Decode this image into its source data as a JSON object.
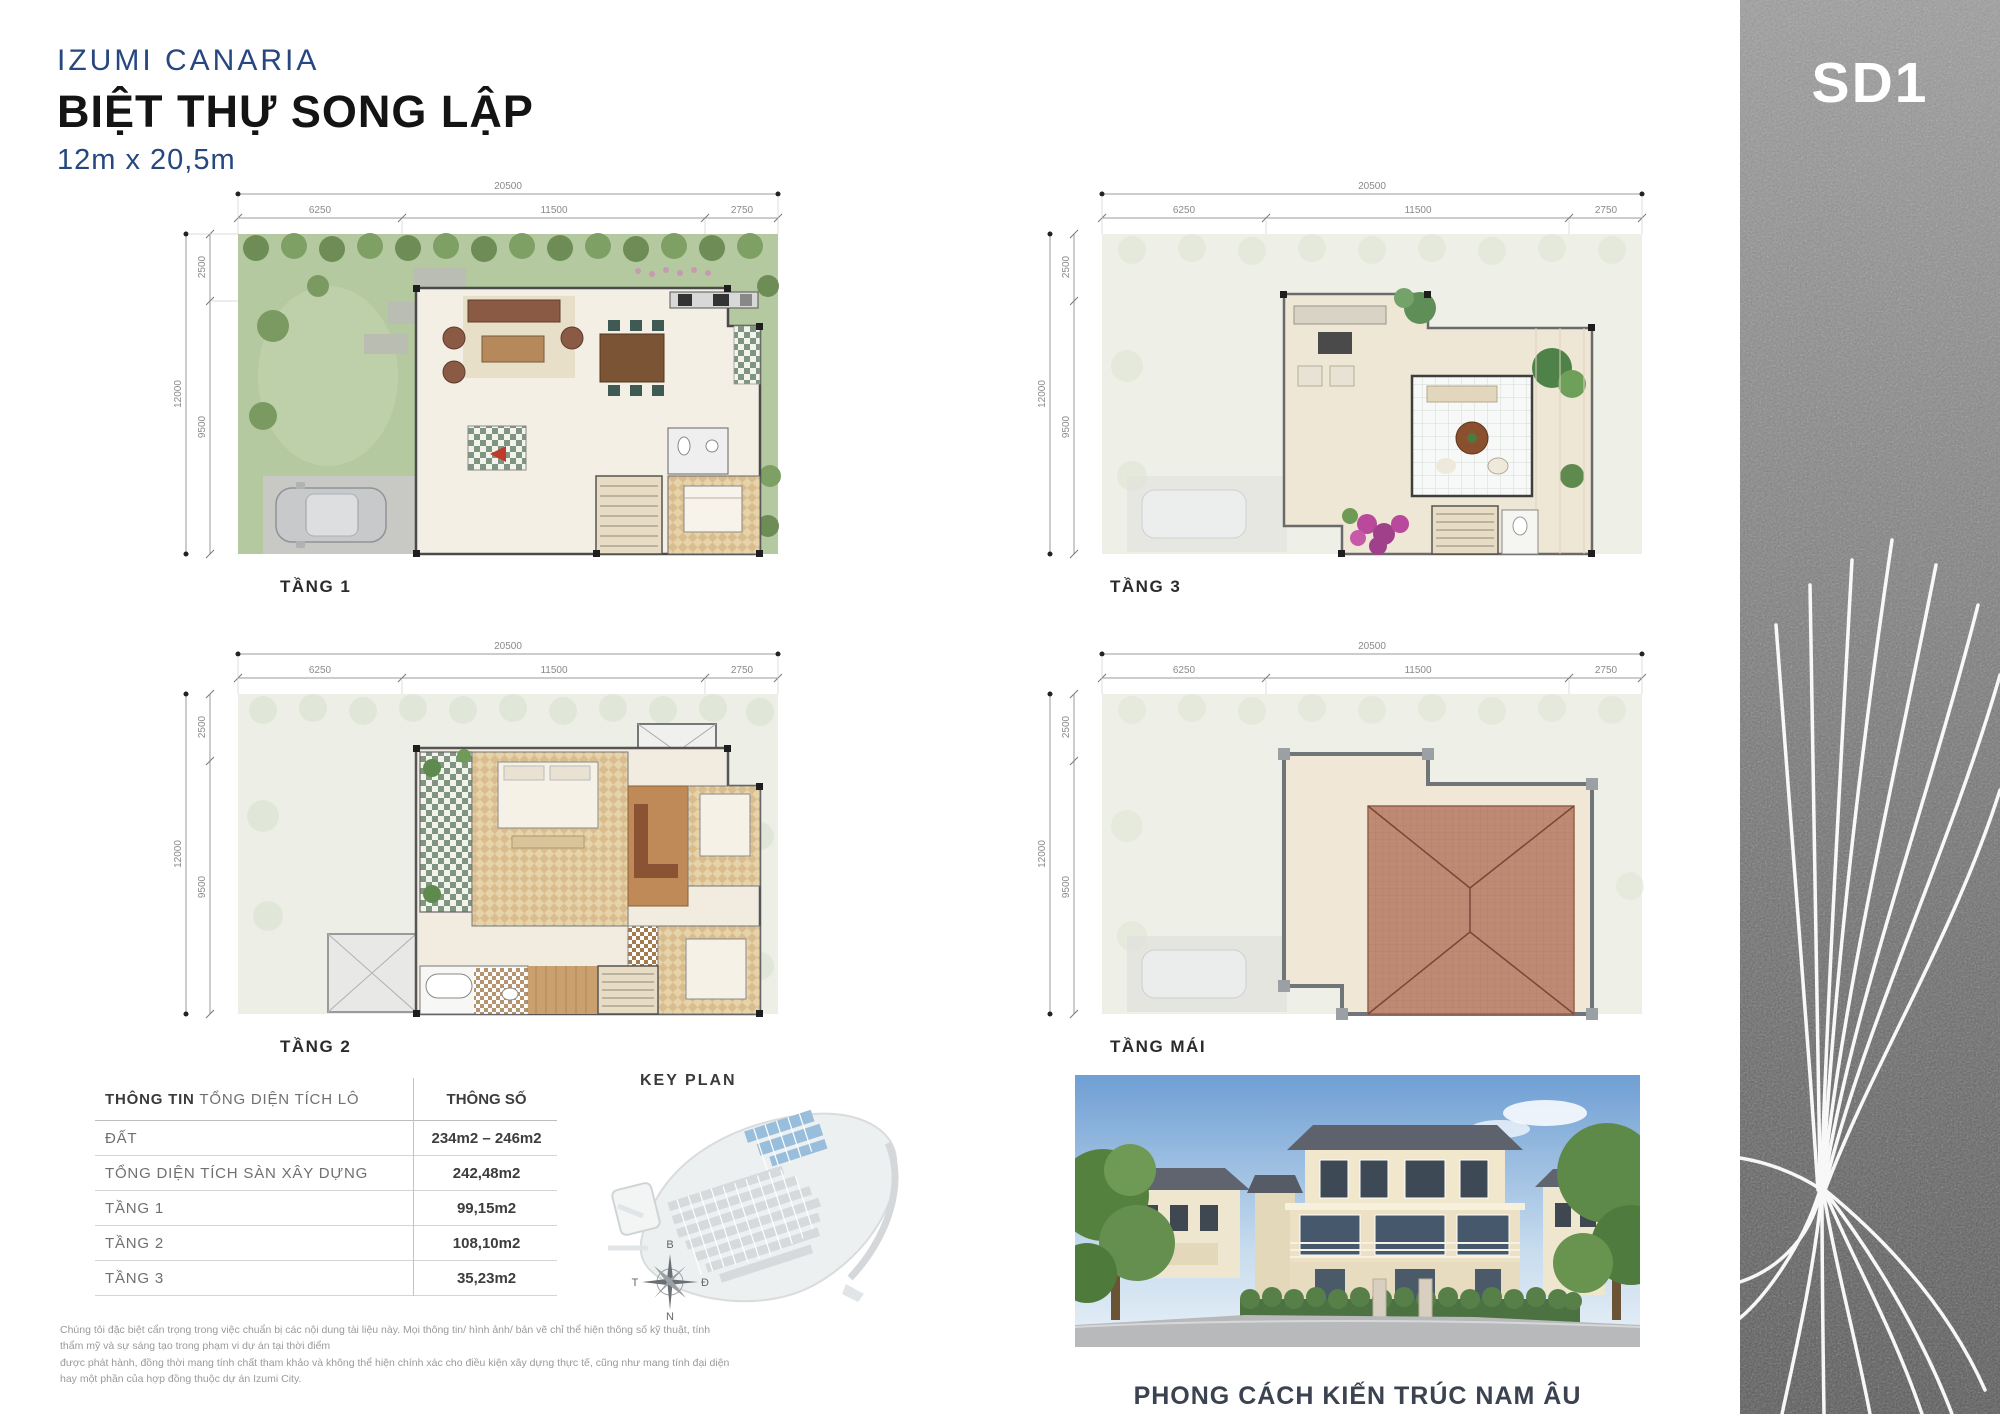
{
  "page": {
    "project": "IZUMI CANARIA",
    "title": "BIỆT THỰ SONG LẬP",
    "size": "12m x 20,5m",
    "code": "SD1"
  },
  "plans": {
    "dims": {
      "total_w": "20500",
      "seg_w1": "6250",
      "seg_w2": "11500",
      "seg_w3": "2750",
      "total_h": "12000",
      "seg_h1": "2500",
      "seg_h2": "9500"
    },
    "floor1_label": "TẦNG 1",
    "floor2_label": "TẦNG 2",
    "floor3_label": "TẦNG 3",
    "roof_label": "TẦNG MÁI"
  },
  "table": {
    "header_info_bold": "THÔNG TIN",
    "header_info_rest": " TỔNG DIỆN TÍCH LÔ",
    "header_value": "THÔNG SỐ",
    "rows": [
      {
        "label": "ĐẤT",
        "value": "234m2 – 246m2"
      },
      {
        "label": "TỔNG DIỆN TÍCH SÀN XÂY DỰNG",
        "value": "242,48m2"
      },
      {
        "label": "TẦNG 1",
        "value": "99,15m2"
      },
      {
        "label": "TẦNG 2",
        "value": "108,10m2"
      },
      {
        "label": "TẦNG 3",
        "value": "35,23m2"
      }
    ]
  },
  "keyplan": {
    "title": "KEY PLAN",
    "compass": {
      "n": "B",
      "s": "N",
      "w": "T",
      "e": "Đ"
    }
  },
  "villa": {
    "caption": "PHONG CÁCH KIẾN TRÚC NAM ÂU"
  },
  "disclaimer": {
    "line1": "Chúng tôi đặc biệt cẩn trọng trong việc chuẩn bị các nội dung tài liệu này. Mọi thông tin/ hình ảnh/ bản vẽ chỉ thể hiện thông số kỹ thuật, tính thẩm mỹ và sự sáng tạo trong phạm vi dự án tại thời điểm",
    "line2": "được phát hành, đồng thời mang tính chất tham khảo và không thể hiện chính xác cho điều kiện xây dựng thực tế, cũng như mang tính đại diện hay một phần của hợp đồng thuộc dự án Izumi City."
  },
  "colors": {
    "brand_blue": "#27477e",
    "garden_green": "#b5c9a0",
    "roof_terracotta": "#bf8a74",
    "sidebar_gray": "#7a7a7a"
  }
}
